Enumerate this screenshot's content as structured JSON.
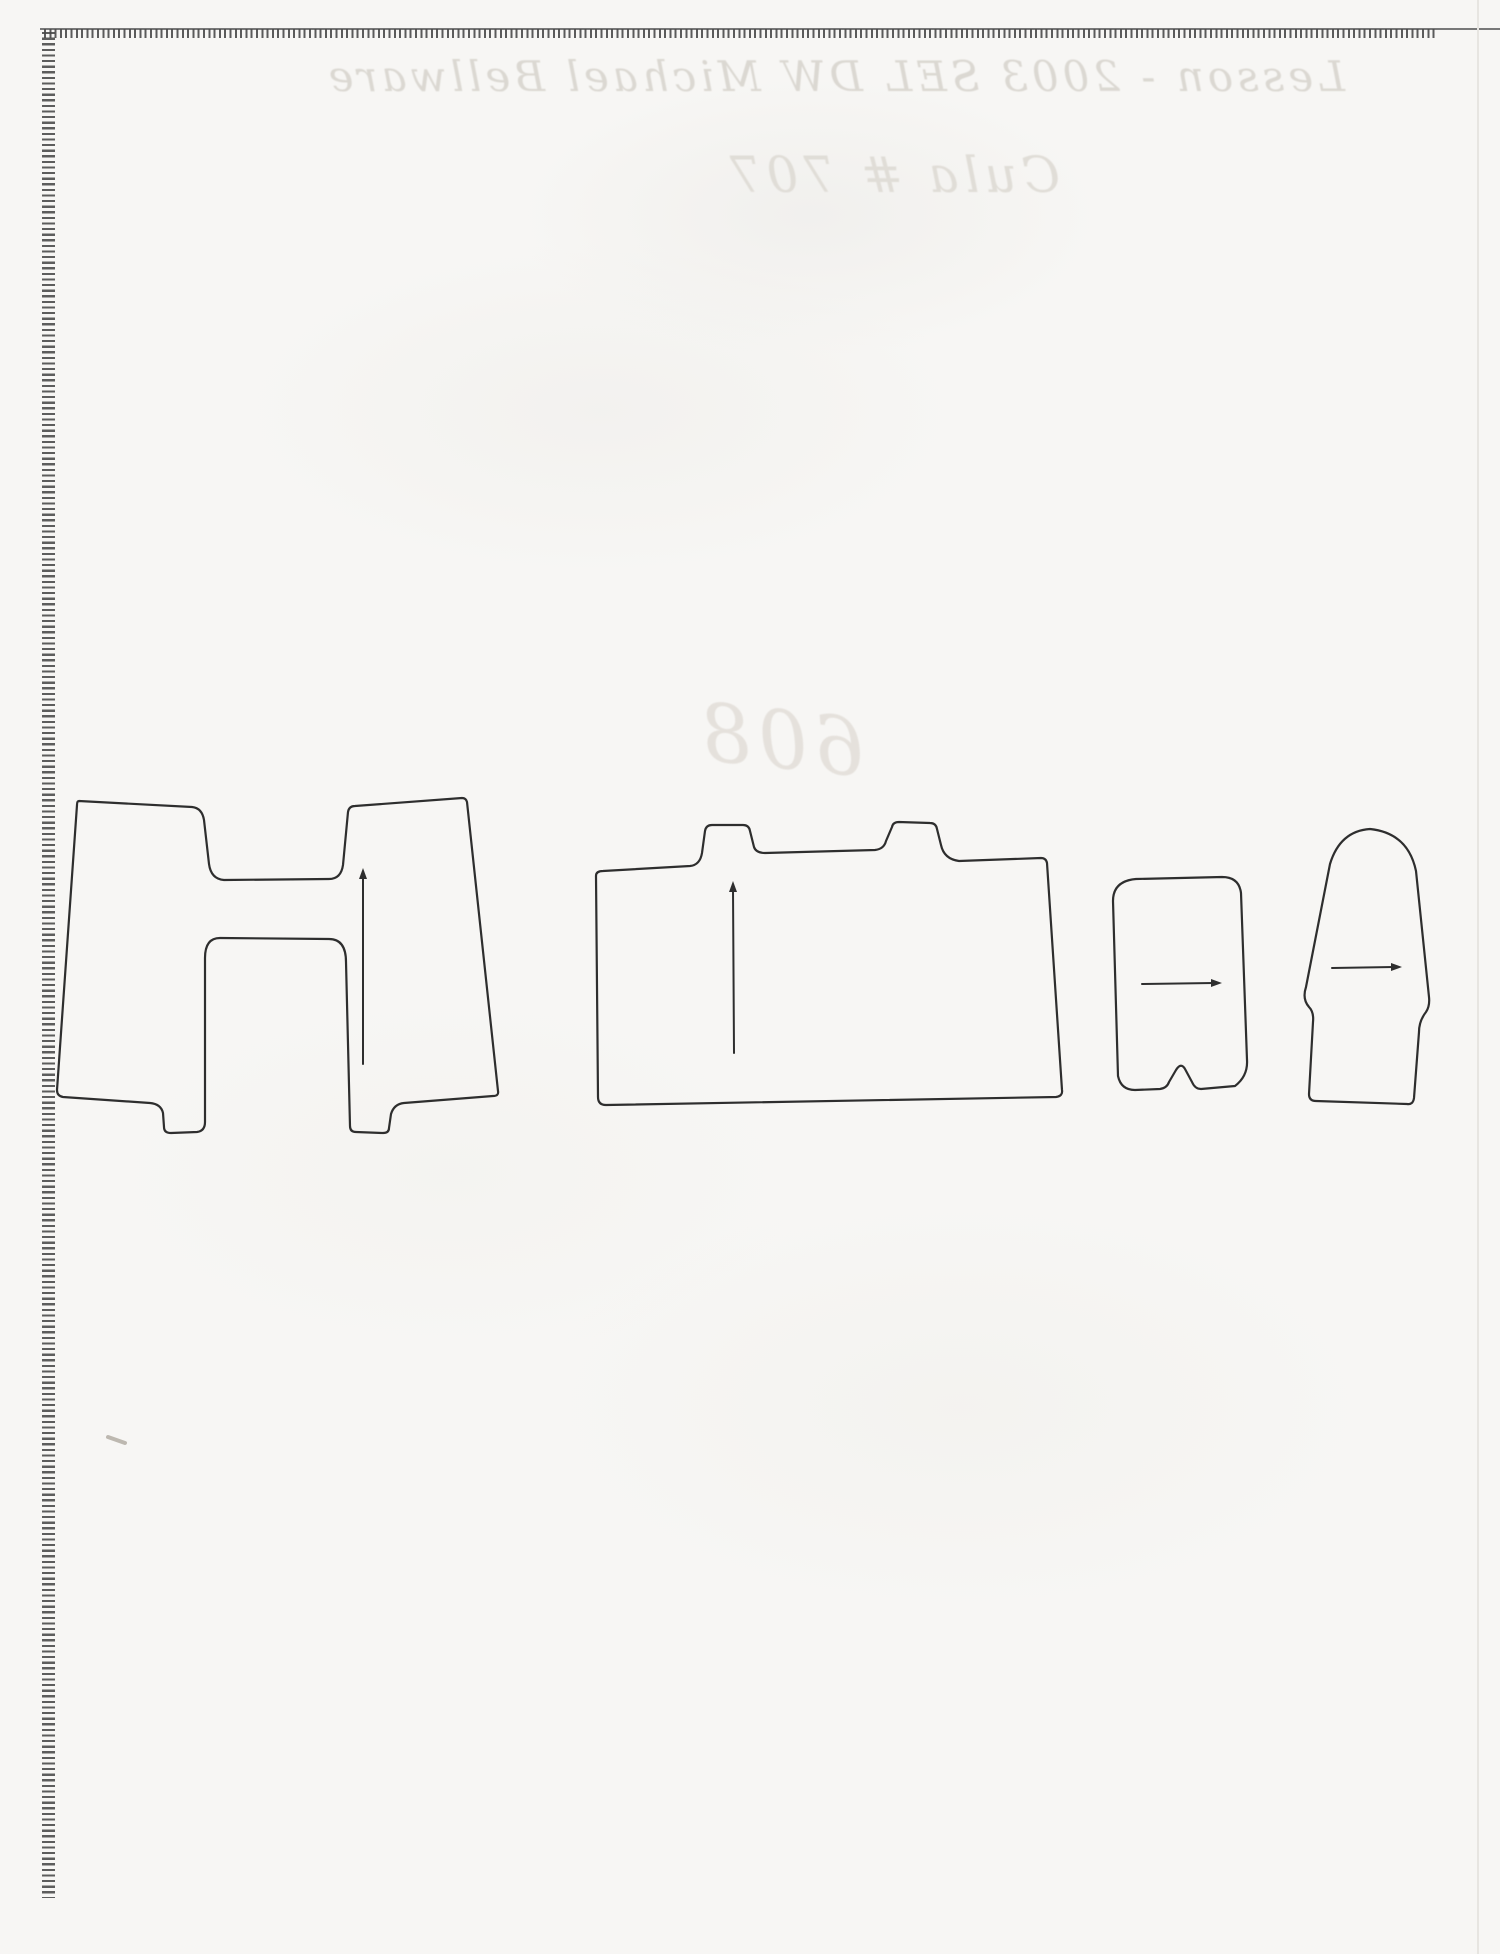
{
  "document": {
    "kind": "scanned sheet of perforated-edge paper with hand-traced template pieces"
  },
  "bleedthrough": {
    "line1": "Lesson - 2003 SEL DW Michael Bellware",
    "line2": "Cula # 707",
    "number": "608"
  },
  "colors": {
    "paper": "#f7f6f4",
    "outline": "#2e2e2e",
    "perforation": "#484848",
    "top_edge_line": "#787878",
    "bleedthrough_text": "#dbd8d2",
    "scratch": "#bdb8b0",
    "scanner_streak": "#e7e5e1"
  },
  "shapes": [
    {
      "label": "h-shaped piece with two top tabs and two bottom feet",
      "marking": "vertical grain line with top arrow"
    },
    {
      "label": "wide piece with two small top tabs",
      "marking": "vertical grain line with top arrow"
    },
    {
      "label": "small rounded piece with bottom notch bump",
      "marking": "horizontal line with right arrow"
    },
    {
      "label": "dome-top piece with shoulder steps",
      "marking": "horizontal line with right arrow"
    }
  ]
}
